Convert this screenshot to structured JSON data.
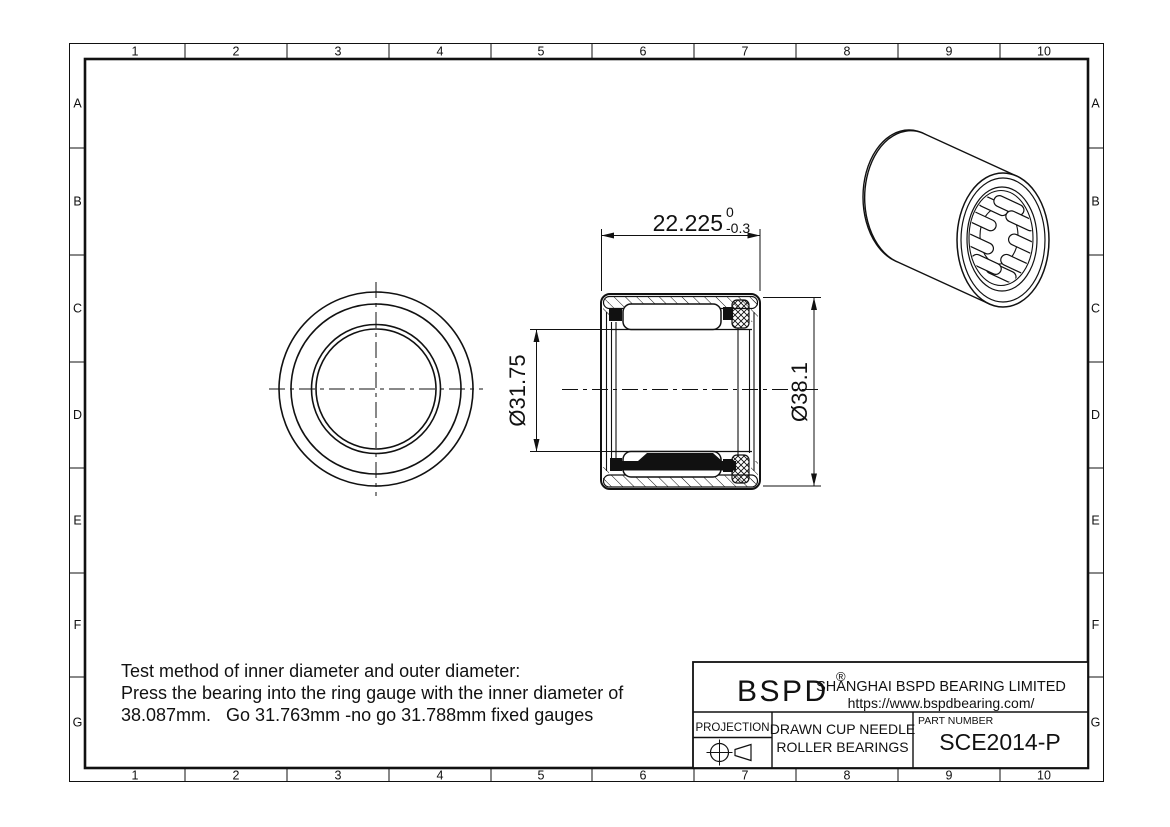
{
  "grid": {
    "columns": [
      "1",
      "2",
      "3",
      "4",
      "5",
      "6",
      "7",
      "8",
      "9",
      "10"
    ],
    "rows": [
      "A",
      "B",
      "C",
      "D",
      "E",
      "F",
      "G"
    ]
  },
  "dimensions": {
    "width_value": "22.225",
    "width_tol_upper": "0",
    "width_tol_lower": "-0.3",
    "bore_diameter": "Ø31.75",
    "outer_diameter": "Ø38.1"
  },
  "notes": {
    "line1": "Test method of inner diameter and outer diameter:",
    "line2": "Press the bearing into the ring gauge with the inner diameter of",
    "line3": "38.087mm.   Go 31.763mm -no go 31.788mm fixed gauges"
  },
  "title_block": {
    "logo": "BSPD",
    "registered_mark": "®",
    "company_name": "SHANGHAI BSPD BEARING LIMITED",
    "website": "https://www.bspdbearing.com/",
    "projection_label": "PROJECTION",
    "product_line1": "DRAWN CUP NEEDLE",
    "product_line2": "ROLLER BEARINGS",
    "part_number_label": "PART NUMBER",
    "part_number": "SCE2014-P"
  },
  "colors": {
    "line": "#111111",
    "background": "#ffffff"
  }
}
